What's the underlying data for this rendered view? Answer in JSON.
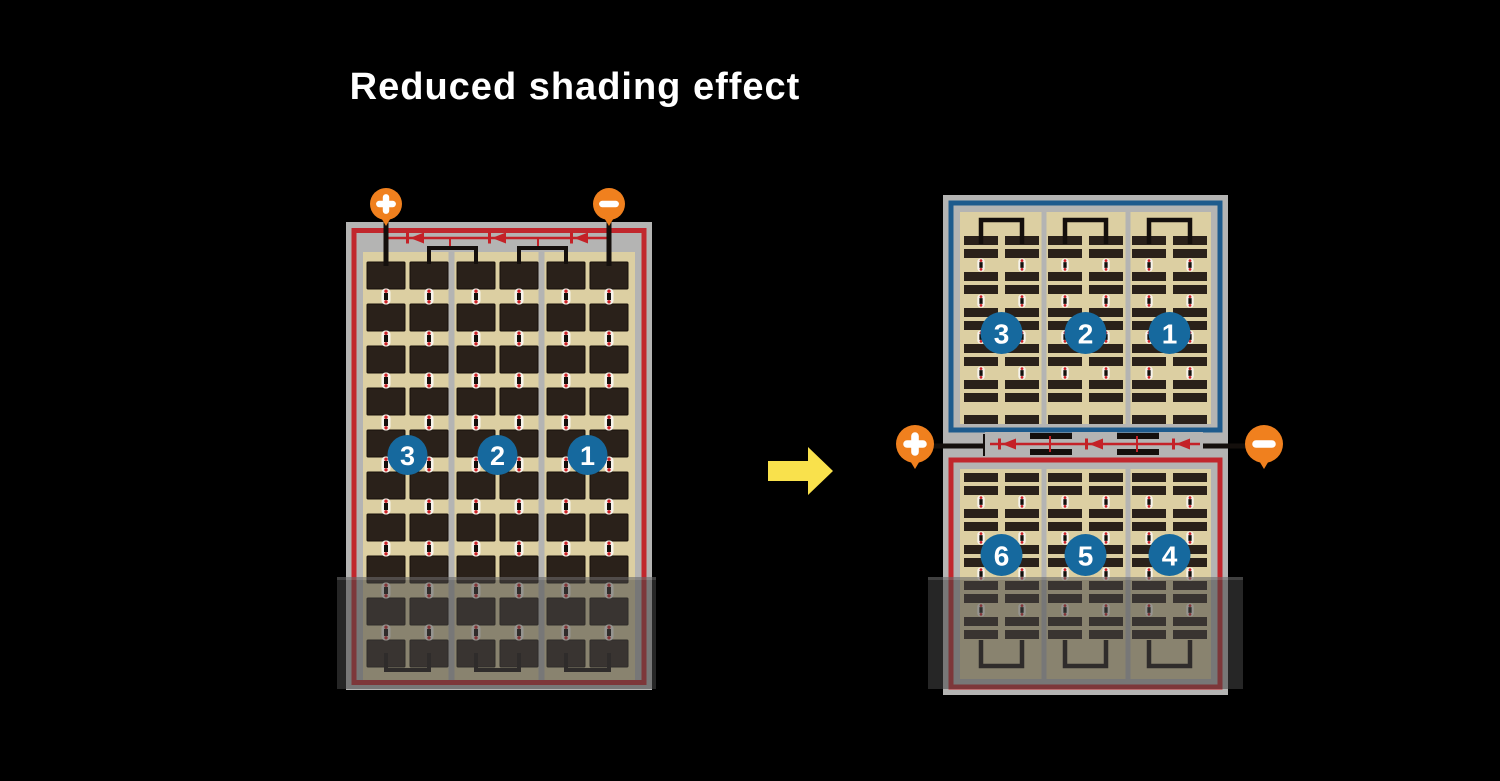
{
  "title": "Reduced shading effect",
  "colors": {
    "background": "#000000",
    "title_text": "#ffffff",
    "frame_gray": "#b4b4b3",
    "cream": "#dccfa2",
    "cell_dark": "#2a211a",
    "cell_edge": "#17100b",
    "panel_red": "#c1272d",
    "panel_blue": "#1e5b8d",
    "badge_blue": "#16699e",
    "badge_text": "#ffffff",
    "terminal_orange": "#f0801e",
    "terminal_glyph": "#ffffff",
    "diode_red": "#c42127",
    "wire_black": "#140f0c",
    "divider_gray": "#b4b4b3",
    "connector_white": "#f7f4ec",
    "connector_dot": "#cc2127",
    "arrow_yellow": "#f9e14c",
    "shade_overlay": "rgba(70,70,70,0.55)",
    "shade_edge": "rgba(255,255,255,0.12)"
  },
  "before_panel": {
    "strings": [
      "3",
      "2",
      "1"
    ],
    "terminals": {
      "positive": "+",
      "negative": "-"
    }
  },
  "after_panel": {
    "top_strings": [
      "3",
      "2",
      "1"
    ],
    "bottom_strings": [
      "6",
      "5",
      "4"
    ],
    "terminals": {
      "positive": "+",
      "negative": "-"
    }
  },
  "icons": {
    "positive_terminal": "plus-icon",
    "negative_terminal": "minus-icon",
    "bypass_diode": "diode-arrow-icon",
    "transform": "right-arrow-icon",
    "shading": "shade-overlay"
  }
}
